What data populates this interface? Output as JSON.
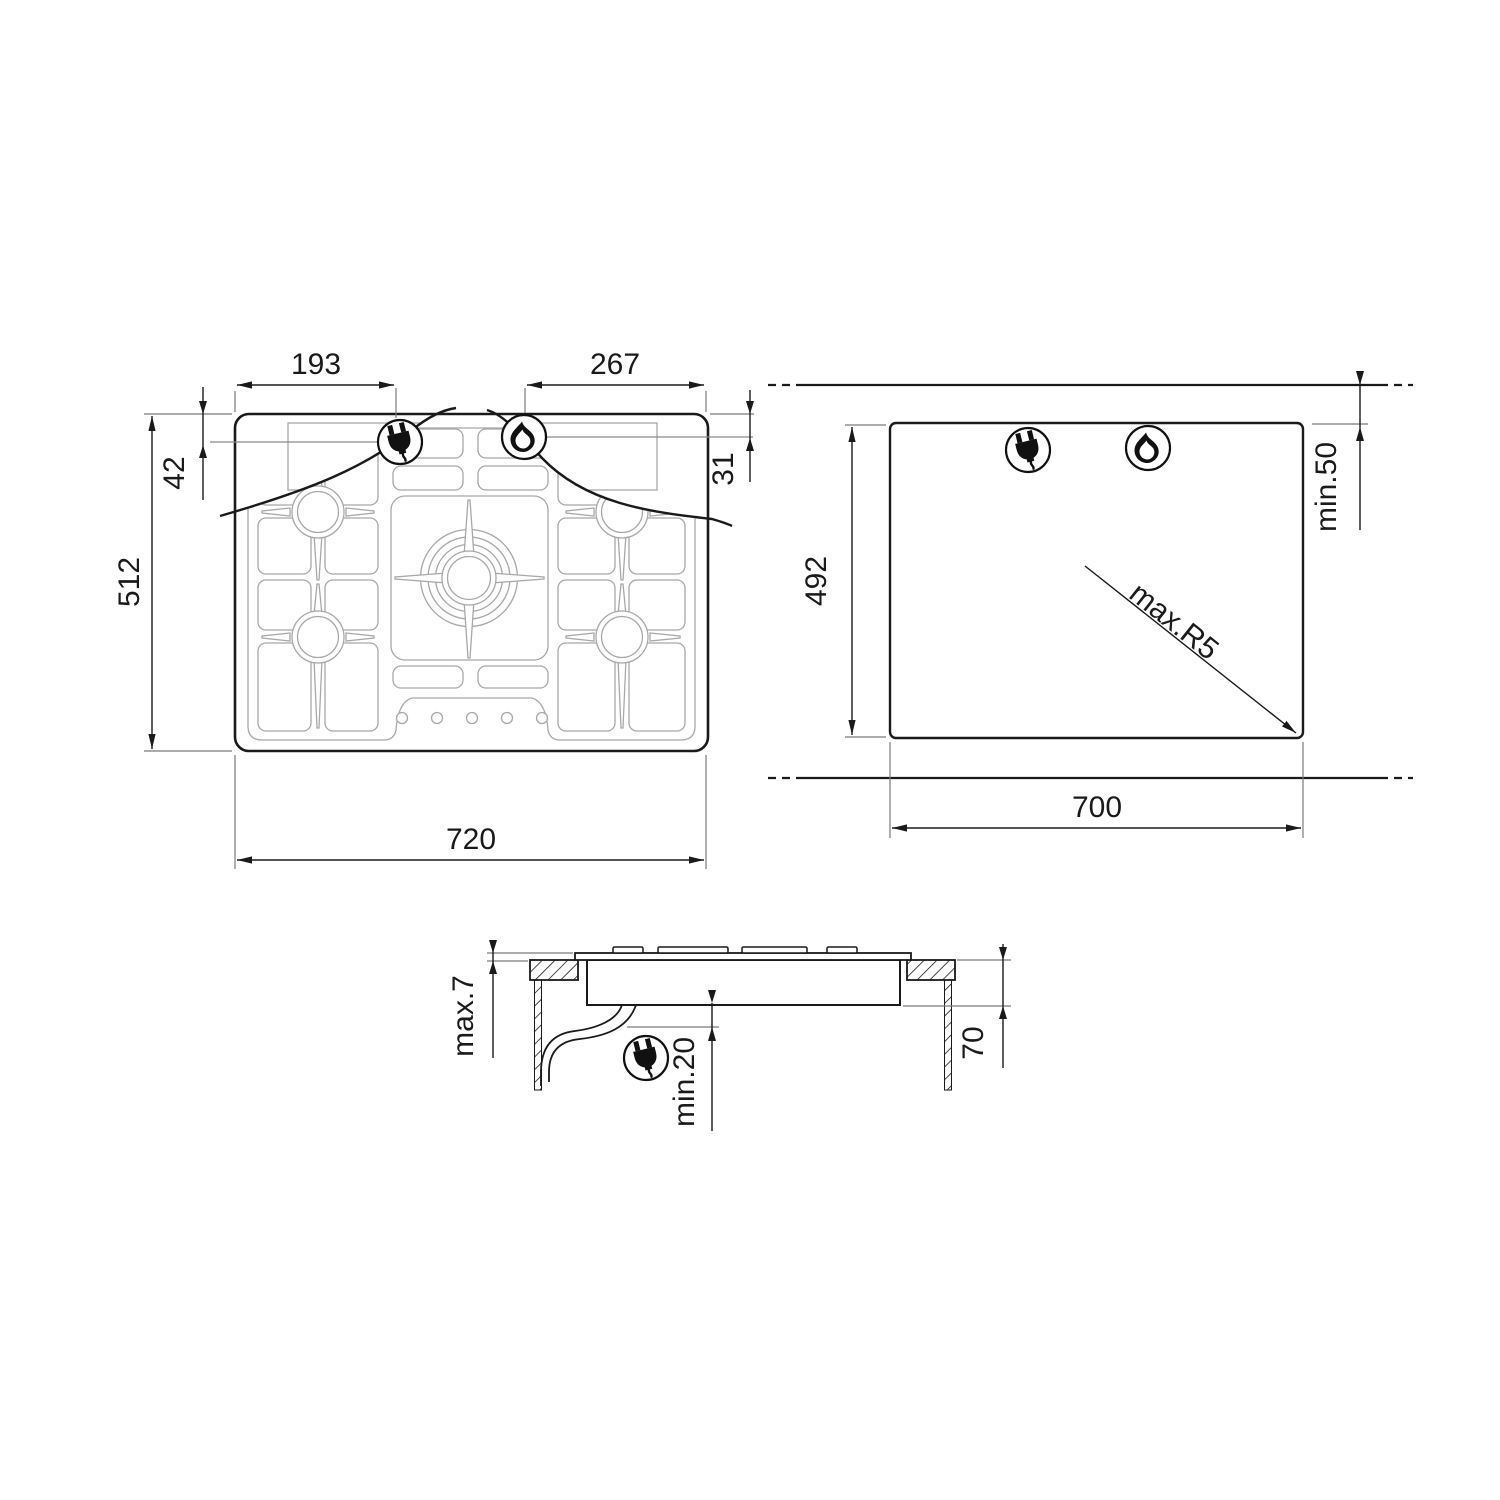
{
  "top_view": {
    "dim_plug_from_left": "193",
    "dim_flame_from_right": "267",
    "dim_plug_from_top": "42",
    "dim_flame_from_top": "31",
    "dim_depth": "512",
    "dim_width": "720"
  },
  "cutout_view": {
    "dim_depth": "492",
    "dim_width": "700",
    "dim_rear_clearance": "min.50",
    "dim_corner_radius": "max.R5"
  },
  "side_view": {
    "dim_top_thickness": "max.7",
    "dim_cable_clearance": "min.20",
    "dim_body_depth": "70"
  },
  "icons": {
    "plug": "power-plug-icon",
    "flame": "gas-flame-icon"
  },
  "colors": {
    "line": "#1a1a1a",
    "pattern": "#a8a8a8",
    "extension": "#7a7a7a",
    "background": "#ffffff"
  }
}
